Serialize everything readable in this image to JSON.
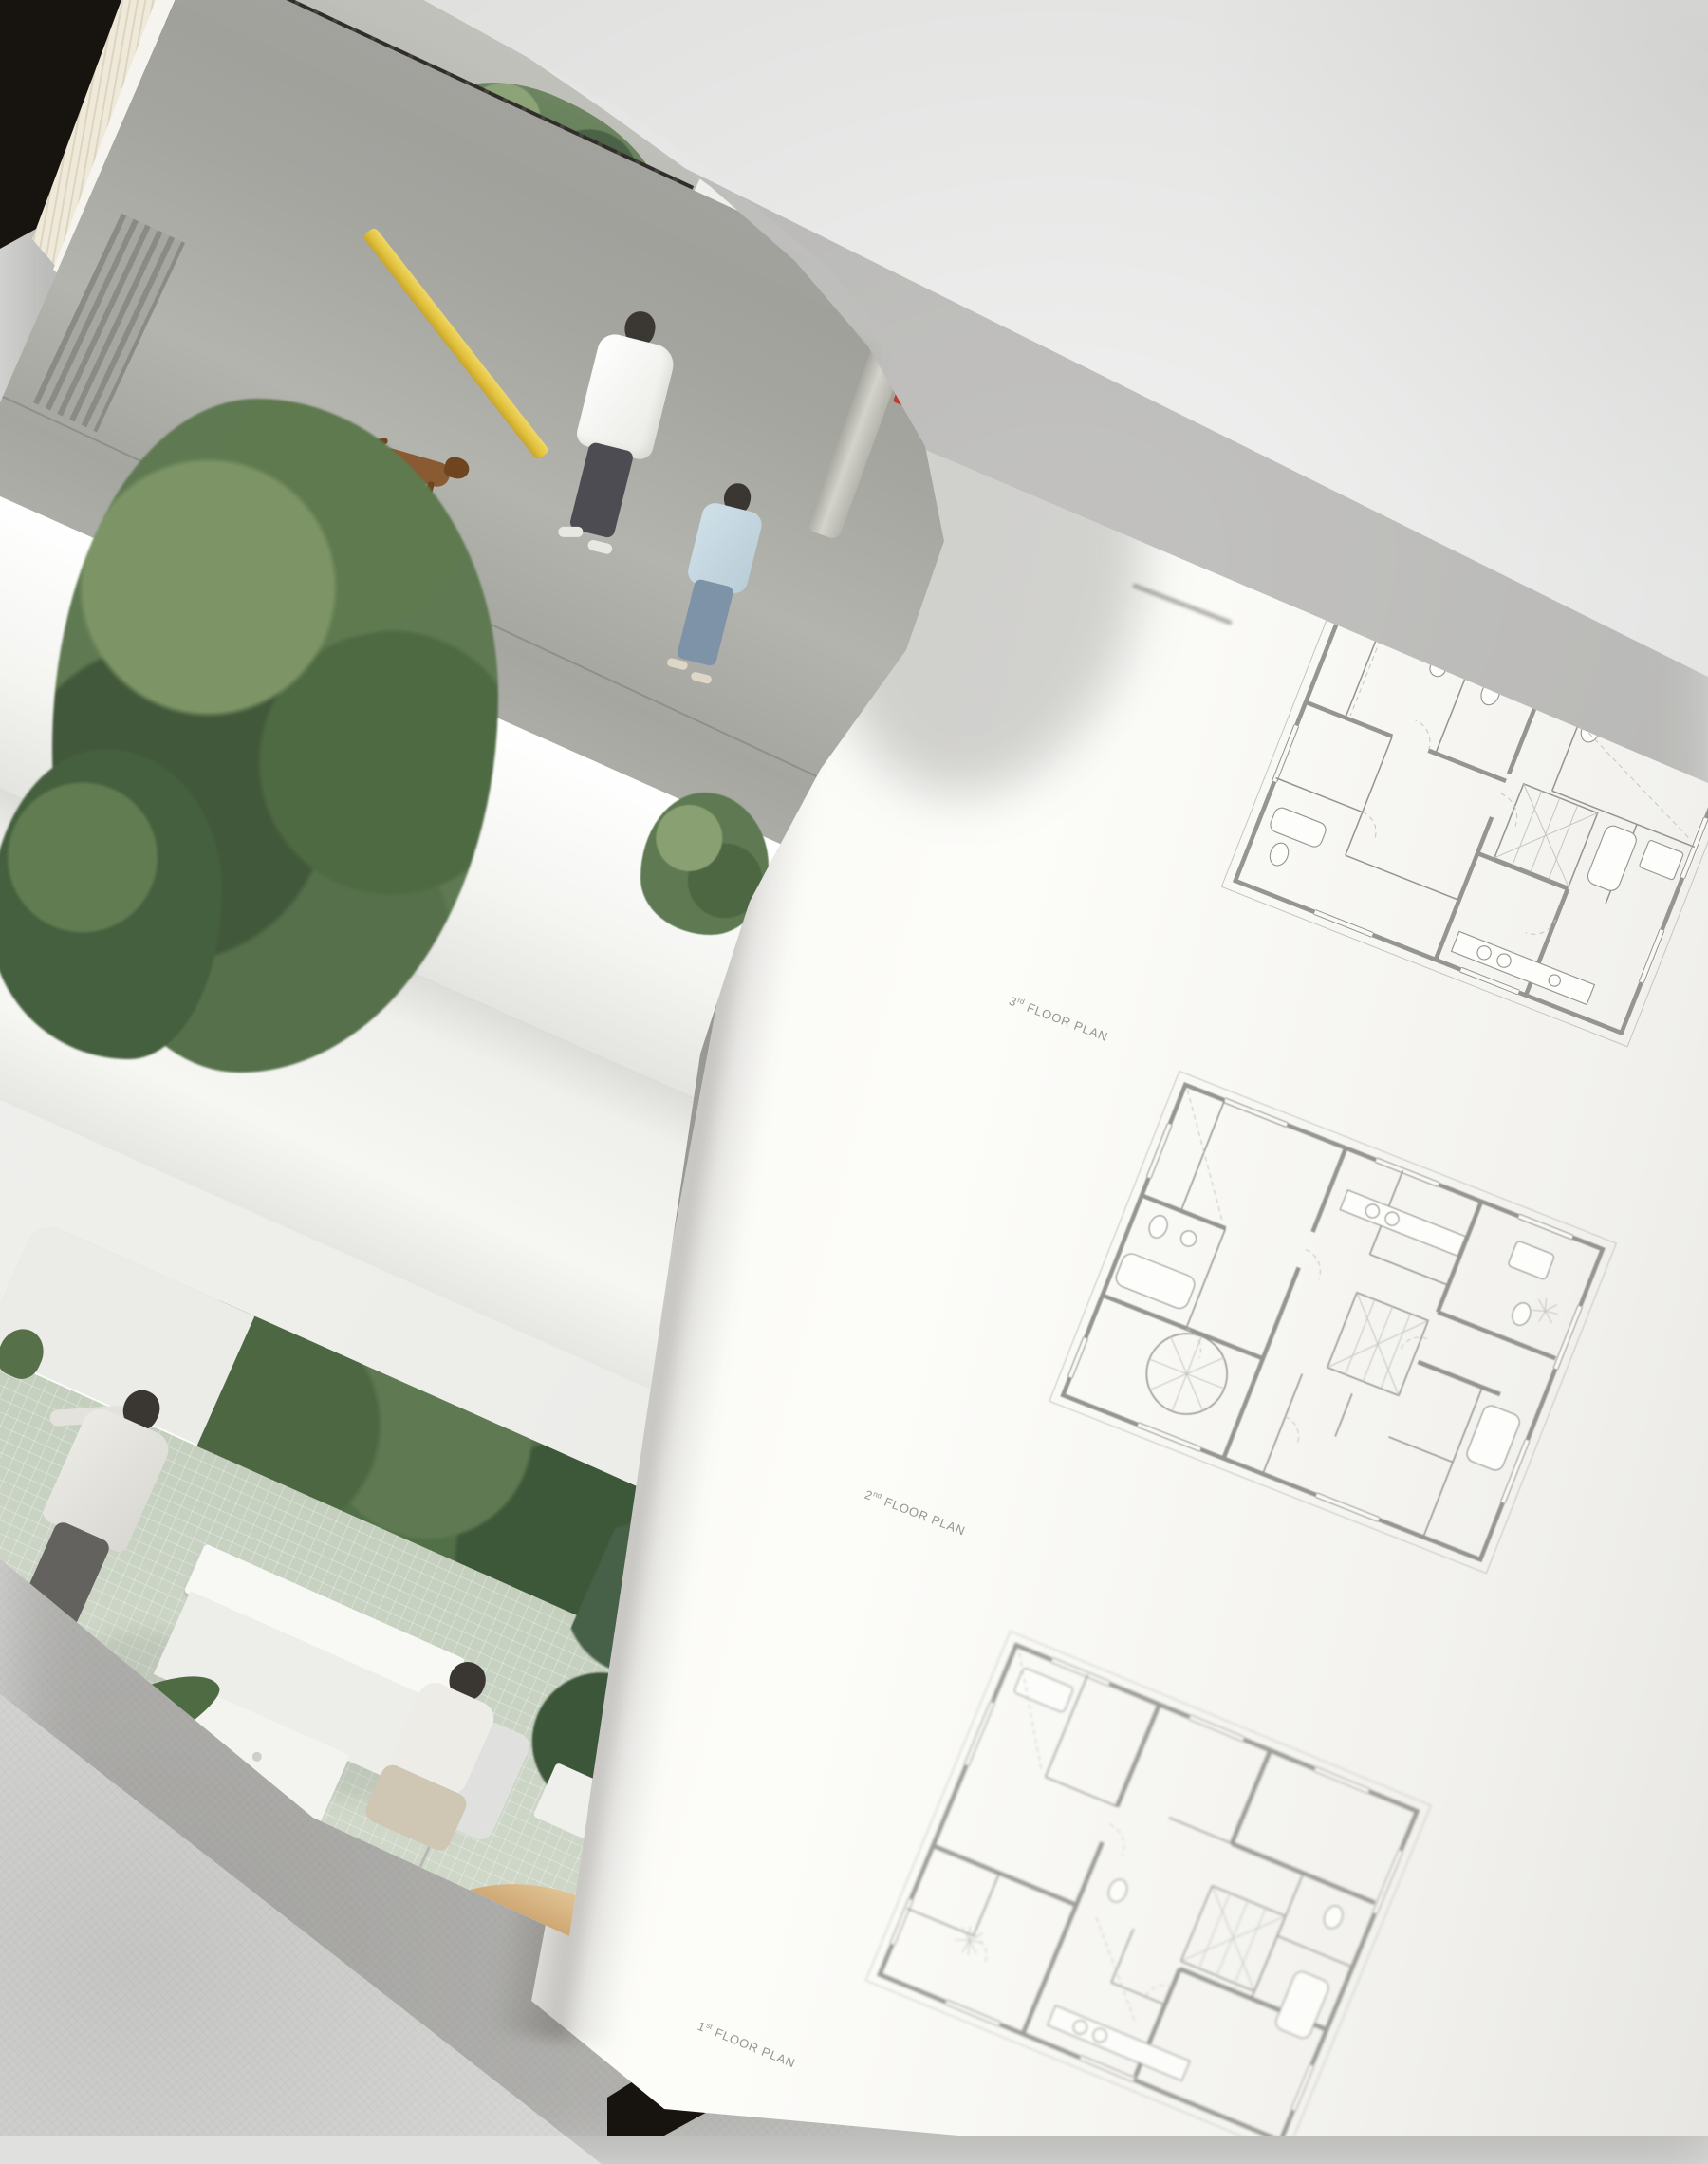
{
  "book": {
    "right_page": {
      "plan_labels": [
        {
          "number": "3",
          "ordinal": "rd",
          "label": "FLOOR PLAN"
        },
        {
          "number": "2",
          "ordinal": "nd",
          "label": "FLOOR PLAN"
        },
        {
          "number": "1",
          "ordinal": "st",
          "label": "FLOOR PLAN"
        }
      ]
    }
  },
  "colors": {
    "backdrop": "#e0e1df",
    "page_white": "#f8f8f5",
    "photo_wall": "#ededea",
    "asphalt": "#a6a6a1",
    "asphalt_worn": "#b4b4ae",
    "sidewalk": "#b9bab3",
    "fence_dark": "#2f2c28",
    "block_wall": "#b3aca0",
    "foliage": "#5f7a52",
    "foliage_dark": "#3d5739",
    "foliage_light": "#849c6e",
    "pole_yellow": "#e2c23e",
    "tile_floor": "#ccd5c6",
    "shirt_white": "#f1f1ee",
    "denim": "#7e93a8",
    "shirt_blue": "#cfe0e8",
    "dog_brown": "#8a5a33",
    "wood": "#c9a06b",
    "cover": "#17130f",
    "book_edge": "#b99065",
    "plan_line": "#95968f",
    "plan_line_light": "#c6c7c1",
    "label_text": "#8b8b85"
  }
}
